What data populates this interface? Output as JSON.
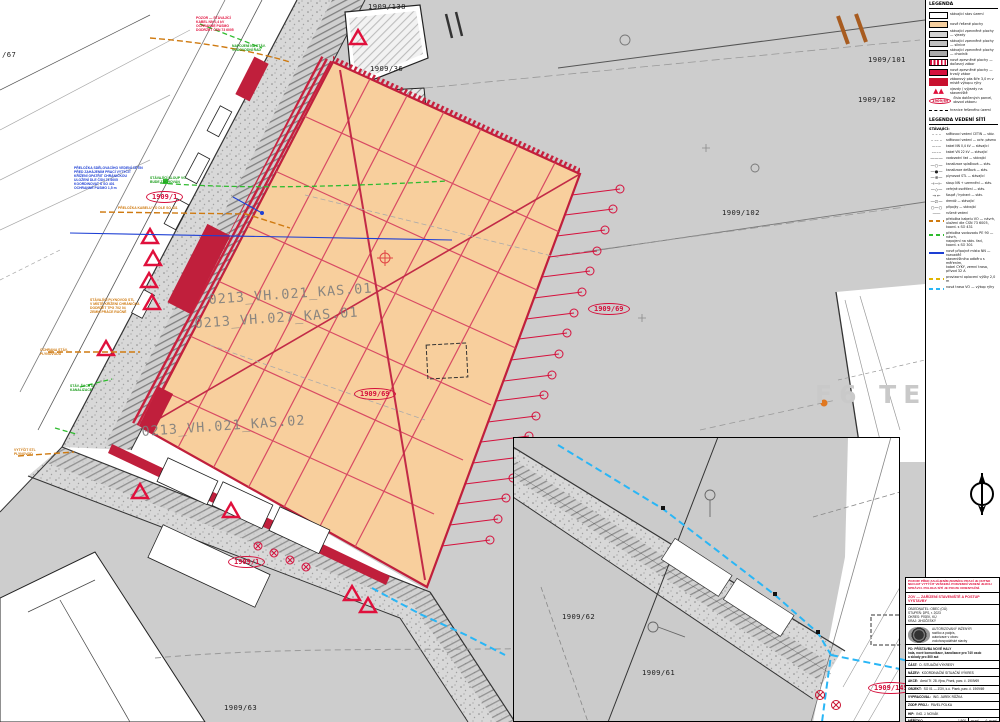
{
  "colors": {
    "orange_area": "#f8cf9d",
    "crimson": "#c8102e",
    "grid_red": "#d84a63",
    "cyan": "#29b6f6",
    "ann_blue": "#1d3fd4",
    "ann_green": "#169a16",
    "ann_orange": "#cf7a10",
    "parcel_gray": "#cdcdcd"
  },
  "parcels": [
    {
      "text": "1909/138"
    },
    {
      "text": "1909/36"
    },
    {
      "text": "1909/101"
    },
    {
      "text": "1909/102"
    },
    {
      "text": "1909/102"
    },
    {
      "text": "1909/63"
    },
    {
      "text": "/67"
    },
    {
      "text": "1909/62"
    },
    {
      "text": "1909/61"
    }
  ],
  "ovals": [
    {
      "text": "1909/1"
    },
    {
      "text": "1909/69"
    },
    {
      "text": "1909/69"
    },
    {
      "text": "1909/1"
    },
    {
      "text": "1909/145"
    }
  ],
  "area_labels": [
    {
      "text": "0213_VH.021_KAS.01"
    },
    {
      "text": "0213_VH.027_KAS.01"
    },
    {
      "text": "0213_VH.021_KAS.02"
    }
  ],
  "watermark": "F6 TE3",
  "annotations": {
    "red_top": "POZOR — STÁVAJÍCÍ\nKABEL NN 0,4 kV\nOCHRANNÉ PÁSMO\nDODRŽET ČSN 73 6005",
    "green_top": "NAPOJENÍ NA STÁV.\nVODOVODNÍ ŘAD",
    "blue_main": "PŘELOŽKA SDĚLOVACÍHO VEDENÍ CETIN\nPŘED ZAHÁJENÍM PRACÍ VYTÝČIT\nKŘÍŽENÍ OPATŘIT CHRÁNIČKOU\nULOŽENÍ DLE ČSN 73 6005\nKOORDINOVAT S SO 401\nOCHRANNÉ PÁSMO 1,5 m",
    "green_mid": "STÁVAJÍCÍ SLOUP VO\nBUDE ZACHOVÁN",
    "orange_1": "PŘELOŽKA KABELU VO DLE SO 431",
    "orange_2": "STÁVAJÍCÍ PLYNOVOD STL\nV MÍSTĚ KŘÍŽENÍ CHRÁNIČKA\nDODRŽET TPG 702 04\nZEMNÍ PRÁCE RUČNĚ",
    "orange_3": "OCHRANA STÁV.\nPLYNOVODU",
    "green_low": "STÁV. ŠACHTA\nKANALIZACE",
    "orange_4": "VYTÝČIT STL\nPLYNOVOD"
  },
  "legend": {
    "title": "LEGENDA",
    "items": [
      {
        "label": "stávající stav území"
      },
      {
        "label": "nově řešené plochy"
      },
      {
        "label": "stávající zpevněné plochy — vjezdy"
      },
      {
        "label": "stávající zpevněné plochy — silnice"
      },
      {
        "label": "stávající zpevněné plochy — chodník"
      },
      {
        "label": "nové zpevněné plochy — dočasný zábor"
      },
      {
        "label": "nové zpevněné plochy — trvalý zábor"
      },
      {
        "label": "záborový pás šíře 3,0 m v místě výkopu rýhy"
      },
      {
        "label": "vjezdy / výjezdy na staveniště"
      },
      {
        "sample": "1909/69",
        "label": "čísla dotčených parcel,\nobvod záboru"
      },
      {
        "label": "hranice řešeného území"
      }
    ],
    "utilities_title": "LEGENDA VEDENÍ SÍTÍ",
    "utilities_sub": "STÁVAJÍCÍ:",
    "utilities": [
      {
        "sym": "– – –",
        "label": "sdělovací vedení CETIN — stáv."
      },
      {
        "sym": "– –– –",
        "label": "sdělovací vedení — ochr. pásmo"
      },
      {
        "sym": "–·–·–",
        "label": "kabel NN 0,4 kV — stávající"
      },
      {
        "sym": "–··–··",
        "label": "kabel VN 22 kV — stávající"
      },
      {
        "sym": "———",
        "label": "vodovodní řad — stávající"
      },
      {
        "sym": "—○—",
        "label": "kanalizace splašková — stáv."
      },
      {
        "sym": "—●—",
        "label": "kanalizace dešťová — stáv."
      },
      {
        "sym": "—⊕—",
        "label": "plynovod STL — stávající"
      },
      {
        "sym": "⊣—⊢",
        "label": "sloup NN + uzemnění — stáv."
      },
      {
        "sym": "—◇—",
        "label": "veřejné osvětlení — stáv."
      },
      {
        "sym": "→ ←",
        "label": "šoupě / hydrant — stáv."
      },
      {
        "sym": "—∅—",
        "label": "drenáž — stávající"
      },
      {
        "sym": "○—○",
        "label": "přípojky — stávající"
      },
      {
        "sym": "┄┄┄",
        "label": "rušené vedení"
      }
    ],
    "colored": [
      {
        "color": "#cf7a10",
        "dash": true,
        "label": "přeložka kabelu VO — návrh,\nuložení dle ČSN 73 6005,\nkoord. s SO 431"
      },
      {
        "color": "#2fbb2f",
        "dash": true,
        "label": "přeložka vodovodu PE 90 — návrh,\nnapojení na stáv. řad,\nkoord. s SO 301"
      },
      {
        "color": "#1d3fd4",
        "dash": false,
        "label": "nové přípojné místo NN — rozvaděč\nstaveništního odběru s měřením,\nkabel CYKY, zemní trasa,\npřívod 32 A"
      },
      {
        "color": "#e0b400",
        "dash": true,
        "label": "provizorní oplocení výšky 2,0 m"
      },
      {
        "color": "#29b6f6",
        "dash": true,
        "label": "nová trasa VO — výkop rýhy"
      }
    ]
  },
  "titleblock": {
    "warning": "POZOR! PŘED ZAHÁJENÍM ZEMNÍCH PRACÍ JE NUTNO NECHAT VYTÝČIT VEŠKERÁ PODZEMNÍ VEDENÍ JEJICH SPRÁVCI. POLOHA SÍTÍ JE POUZE ORIENTAČNÍ.",
    "red_title": "ZOV — ZAŘÍZENÍ STAVENIŠTĚ A POSTUP VÝSTAVBY",
    "info_lines": "OBJEDNATEL: OBEC (OÚ)\nSTUPEŇ: DPS, r. 2023\nOKRES: PÍSEK, KÚ\nKRAJ: JIHOČESKÝ",
    "authoriz": "AUTORIZOVANÝ INŽENÝR\nrazítko a podpis,\nautorizace v oboru\nvodohospodářské stavby",
    "object_lines": "PD: PŘÍSTAVBA NOVÉ HALY\nhala, nové komunikace, kanalizace pro 740 osob\na sklady pro 800 aut",
    "rows": [
      {
        "k": "ČÁST:",
        "v": "D. SITUAČNÍ VÝKRESY"
      },
      {
        "k": "NÁZEV:",
        "v": "KOORDINAČNÍ SITUAČNÍ VÝKRES"
      },
      {
        "k": "AKCE:",
        "v": "Areál Tř. 28. října, Písek, parc. č. 1909/69"
      },
      {
        "k": "OBJEKT:",
        "v": "SO 01 — ZOV, k.ú. Písek, parc. č. 1909/69"
      },
      {
        "k": "VYPRACOVAL:",
        "v": "ING. JAREK RŮŽKA"
      },
      {
        "k": "ZODP. PROJ.:",
        "v": "PAVEL POLKA"
      },
      {
        "k": "HIP:",
        "v": "ING. J. NOVÁK"
      }
    ],
    "meta": [
      {
        "k": "MĚŘÍTKO",
        "v": "1:500"
      },
      {
        "k": "DATUM",
        "v": "10/2023"
      },
      {
        "k": "FORMÁT",
        "v": "8×A4"
      },
      {
        "k": "Č. ZAKÁZKY",
        "v": "230-2023"
      },
      {
        "k": "Č. VÝKRESU",
        "v": ""
      }
    ],
    "pare_label": "PARÉ",
    "pare_no": "Č. PARÉ",
    "drawing_no": "C03"
  }
}
